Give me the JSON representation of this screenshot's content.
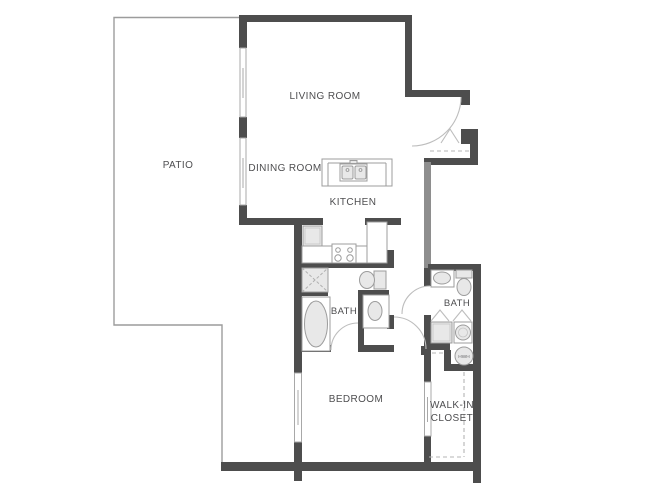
{
  "plan": {
    "rooms": {
      "patio": "PATIO",
      "living_room": "LIVING ROOM",
      "dining_room": "DINING ROOM",
      "kitchen": "KITCHEN",
      "bath_main": "BATH",
      "bath_guest": "BATH",
      "bedroom": "BEDROOM",
      "walk_in_closet_line1": "WALK-IN",
      "walk_in_closet_line2": "CLOSET",
      "water_heater": "HWH"
    },
    "fixtures": [
      "kitchen-island-double-sink",
      "refrigerator",
      "range-stove",
      "upper-cabinets-dashed",
      "shower",
      "bathtub",
      "toilet-main-bath",
      "vanity-sink-main-bath",
      "toilet-guest-bath",
      "vanity-sink-guest-bath",
      "washer",
      "dryer",
      "water-heater",
      "entry-coat-closet",
      "closet-shelving-dashed"
    ],
    "colors": {
      "background": "#ffffff",
      "wall_dark": "#4d4d4d",
      "wall_medium": "#8e8e8e",
      "fixture_line": "#9c9c9c",
      "fixture_fill": "#e8e8e8",
      "dashed_line": "#b4b4b4",
      "text": "#4e4e50"
    }
  }
}
